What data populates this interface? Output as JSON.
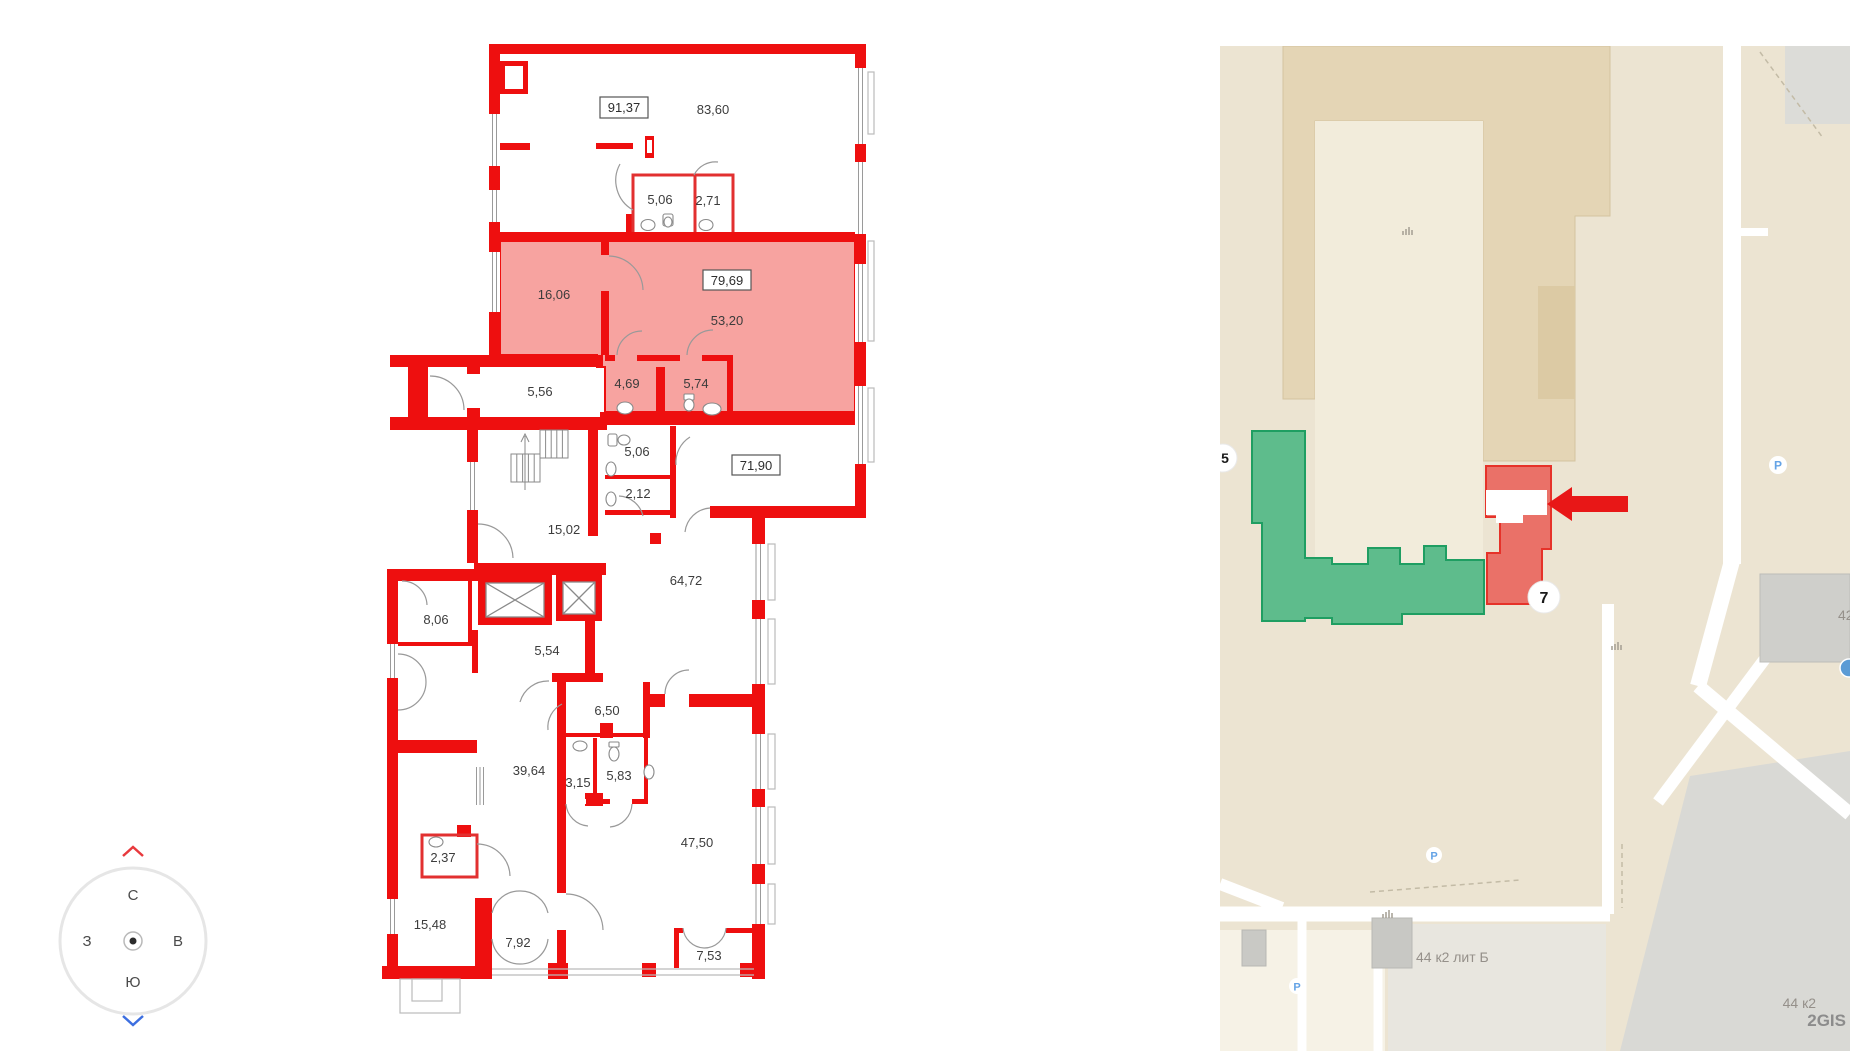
{
  "plan": {
    "units": [
      {
        "value": "91,37"
      },
      {
        "value": "79,69"
      },
      {
        "value": "71,90"
      }
    ],
    "rooms": [
      {
        "value": "83,60"
      },
      {
        "value": "5,06"
      },
      {
        "value": "2,71"
      },
      {
        "value": "16,06"
      },
      {
        "value": "53,20"
      },
      {
        "value": "4,69"
      },
      {
        "value": "5,74"
      },
      {
        "value": "5,56"
      },
      {
        "value": "5,06"
      },
      {
        "value": "2,12"
      },
      {
        "value": "15,02"
      },
      {
        "value": "64,72"
      },
      {
        "value": "8,06"
      },
      {
        "value": "5,54"
      },
      {
        "value": "6,50"
      },
      {
        "value": "39,64"
      },
      {
        "value": "3,15"
      },
      {
        "value": "5,83"
      },
      {
        "value": "2,37"
      },
      {
        "value": "47,50"
      },
      {
        "value": "15,48"
      },
      {
        "value": "7,92"
      },
      {
        "value": "7,53"
      }
    ],
    "colors": {
      "wall": "#ee0f0f",
      "highlight": "#f7a3a0"
    }
  },
  "compass": {
    "n": "С",
    "s": "Ю",
    "w": "З",
    "e": "В"
  },
  "map": {
    "badge_main": "7",
    "badge_left": "5",
    "parking": "Р",
    "labels": {
      "building": "44 к2 лит Б",
      "building_short": "44 к2",
      "number_42": "42",
      "watermark": "2GIS"
    },
    "colors": {
      "green_fill": "#5ebc8c",
      "green_stroke": "#1f9e62",
      "red_fill": "#ea7168",
      "red_stroke": "#e63229",
      "arrow": "#e81717",
      "bg": "#ece4d2"
    }
  }
}
